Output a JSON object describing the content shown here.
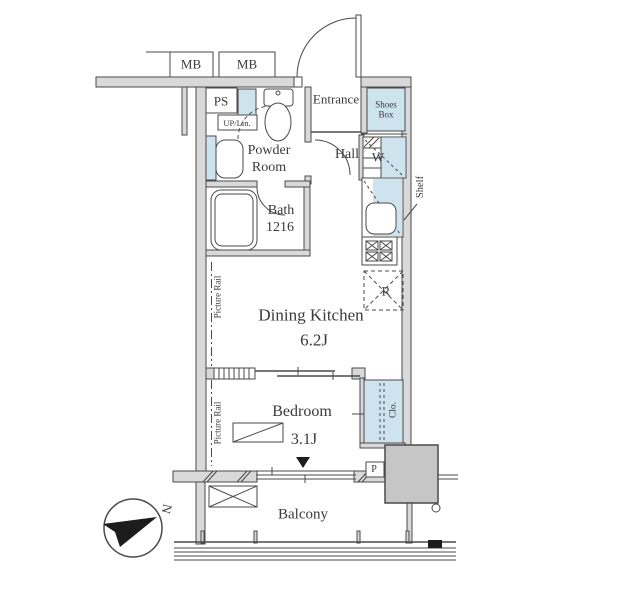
{
  "plan": {
    "title": "apartment-floor-plan",
    "labels": {
      "mb_left": "MB",
      "mb_right": "MB",
      "ps": "PS",
      "up_lin": "UP/Lin.",
      "powder_room_line1": "Powder",
      "powder_room_line2": "Room",
      "entrance": "Entrance",
      "shoes_box_line1": "Shoes",
      "shoes_box_line2": "Box",
      "hall": "Hall",
      "washer": "W",
      "shelf": "Shelf",
      "bath_line1": "Bath",
      "bath_line2": "1216",
      "picture_rail_dk": "Picture Rail",
      "picture_rail_bedroom": "Picture Rail",
      "dining_kitchen": "Dining Kitchen",
      "dining_kitchen_size": "6.2J",
      "refrigerator": "R",
      "bedroom": "Bedroom",
      "bedroom_size": "3.1J",
      "closet": "Clo.",
      "pipe": "P",
      "balcony": "Balcony",
      "compass_north": "N"
    },
    "colors": {
      "wall_fill": "#d9d9d9",
      "line": "#4a4a4a",
      "fixture_blue": "#cde3ee",
      "column_gray": "#c6c6c6",
      "ink": "#3a3a3a"
    }
  }
}
